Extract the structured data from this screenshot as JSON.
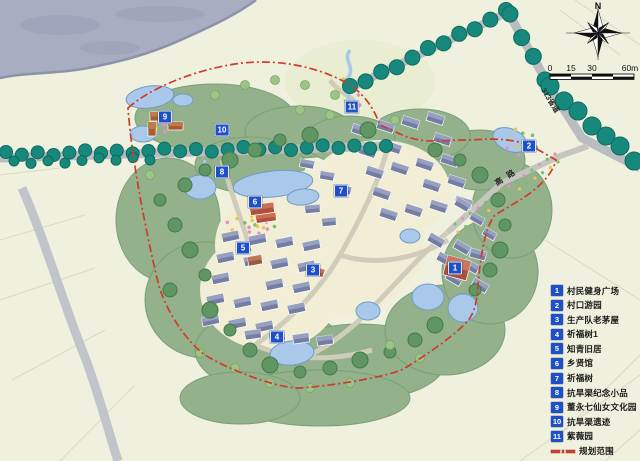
{
  "compass": {
    "north_label": "N"
  },
  "scale_bar": {
    "ticks": [
      "0",
      "15",
      "30",
      "60m"
    ]
  },
  "roads": {
    "labels": [
      {
        "text": "313省道"
      },
      {
        "text": "高路"
      }
    ]
  },
  "legend": {
    "items": [
      {
        "num": "1",
        "label": "村民健身广场"
      },
      {
        "num": "2",
        "label": "村口游园"
      },
      {
        "num": "3",
        "label": "生产队老茅屋"
      },
      {
        "num": "4",
        "label": "祈福树1"
      },
      {
        "num": "5",
        "label": "知青旧居"
      },
      {
        "num": "6",
        "label": "乡贤馆"
      },
      {
        "num": "7",
        "label": "祈福树"
      },
      {
        "num": "8",
        "label": "抗旱渠纪念小品"
      },
      {
        "num": "9",
        "label": "董永七仙女文化园"
      },
      {
        "num": "10",
        "label": "抗旱渠遗迹"
      },
      {
        "num": "11",
        "label": "紫薇园"
      }
    ],
    "boundary_label": "规划范围"
  },
  "map_markers": [
    {
      "num": "1",
      "x": 455,
      "y": 268
    },
    {
      "num": "2",
      "x": 529,
      "y": 146
    },
    {
      "num": "3",
      "x": 313,
      "y": 270
    },
    {
      "num": "4",
      "x": 277,
      "y": 337
    },
    {
      "num": "5",
      "x": 243,
      "y": 248
    },
    {
      "num": "6",
      "x": 255,
      "y": 202
    },
    {
      "num": "7",
      "x": 341,
      "y": 191
    },
    {
      "num": "8",
      "x": 222,
      "y": 172
    },
    {
      "num": "9",
      "x": 165,
      "y": 117
    },
    {
      "num": "10",
      "x": 222,
      "y": 130
    },
    {
      "num": "11",
      "x": 352,
      "y": 107
    }
  ],
  "colors": {
    "marker_blue": "#2050c8",
    "boundary_red": "#d23b2b",
    "tree_teal": "#17897c",
    "pond_blue": "#a9c8ea",
    "lake_gray": "#a8adc2"
  }
}
